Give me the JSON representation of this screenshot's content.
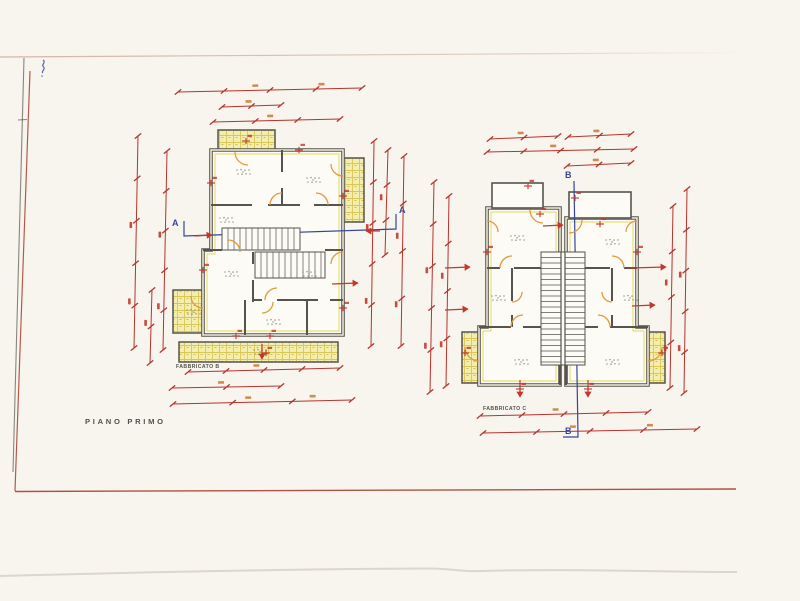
{
  "drawing": {
    "floor_title": "PIANO PRIMO",
    "building_b_label": "FABBRICATO B",
    "building_c_label": "FABBRICATO C",
    "section_a": {
      "left": "A",
      "right": "A"
    },
    "section_b": {
      "top": "B",
      "bottom": "B"
    },
    "colors": {
      "paper": "#f8f5ee",
      "dimension_red": "#b5342c",
      "wall_gray": "#56544c",
      "balcony_yellow": "#f3edae",
      "hatch_line_yellow": "#d8c758",
      "door_orange": "#e09b3d",
      "section_blue": "#35459c",
      "border_red": "#a8402f"
    }
  }
}
